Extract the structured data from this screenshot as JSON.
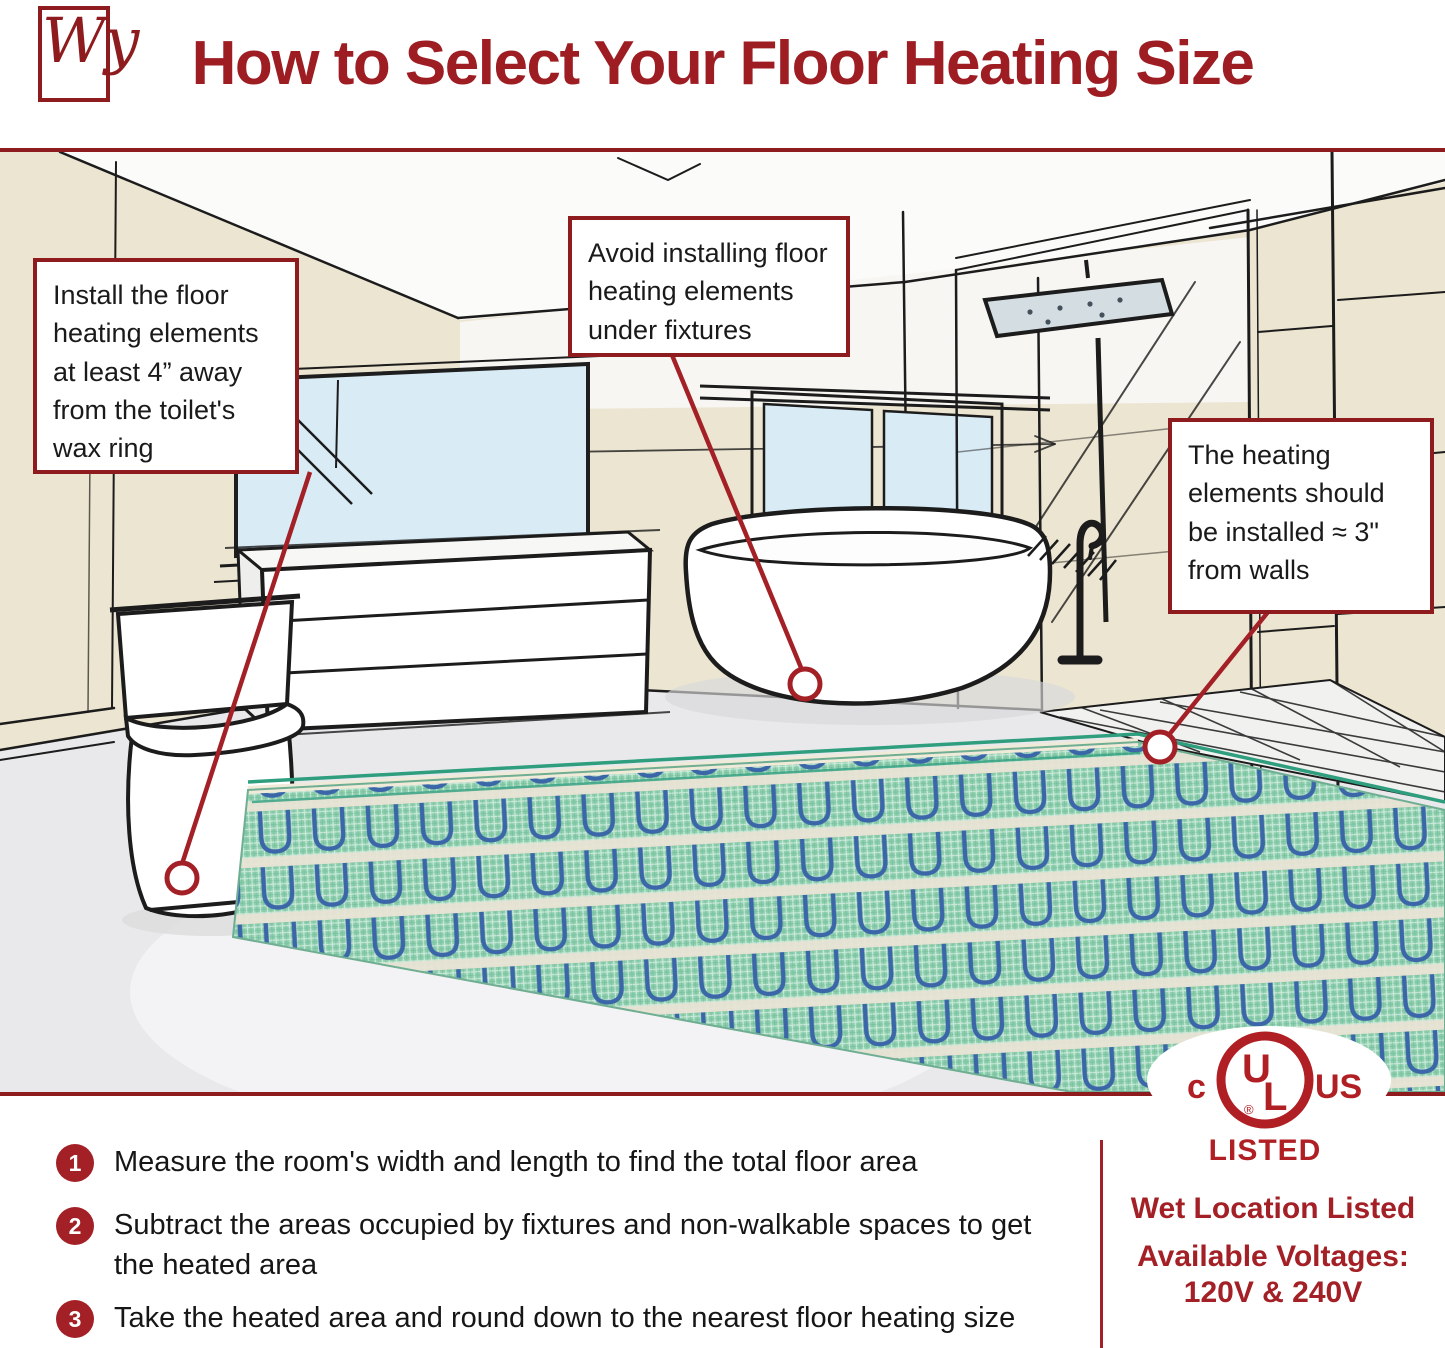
{
  "header": {
    "logo_text": "Wy",
    "title": "How to Select Your Floor Heating Size"
  },
  "callouts": [
    {
      "id": "toilet",
      "text": "Install the floor heating elements at least 4” away from the toilet's wax ring"
    },
    {
      "id": "fixtures",
      "text": "Avoid installing floor heating elements under fixtures"
    },
    {
      "id": "walls",
      "text": "The heating elements should be installed ≈ 3\" from walls"
    }
  ],
  "certification": {
    "c": "c",
    "u": "U",
    "l": "L",
    "registered": "®",
    "us": "US",
    "listed": "LISTED"
  },
  "steps": [
    {
      "number": "1",
      "text": "Measure the room's width and length to find the total floor area"
    },
    {
      "number": "2",
      "text": "Subtract the areas occupied by fixtures and non-walkable spaces to get the heated area"
    },
    {
      "number": "3",
      "text": "Take the heated area and round down to the nearest floor heating size"
    }
  ],
  "footer_right": {
    "line1": "Wet Location Listed",
    "line2": "Available Voltages:",
    "line3": "120V & 240V"
  },
  "colors": {
    "accent_red": "#9d1d23",
    "border_red": "#8e1c1f",
    "badge_red": "#a32026",
    "ul_red": "#b01f24",
    "wall_cream": "#ece5d1",
    "window_blue": "#d9ecf6",
    "mat_green": "#8ccfad",
    "cable_blue": "#3b67a8",
    "floor_gray": "#e9e9eb"
  }
}
